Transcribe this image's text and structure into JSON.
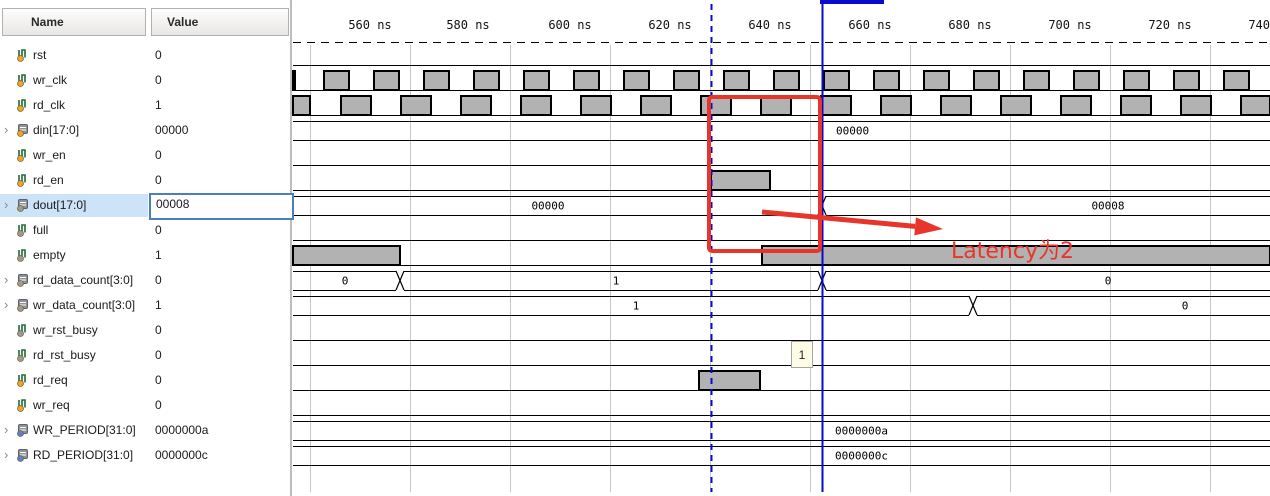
{
  "panel": {
    "columns": {
      "name": "Name",
      "value": "Value"
    },
    "signals": [
      {
        "name": "rst",
        "value": "0",
        "kind": "scalar",
        "dot": "input"
      },
      {
        "name": "wr_clk",
        "value": "0",
        "kind": "scalar",
        "dot": "input"
      },
      {
        "name": "rd_clk",
        "value": "1",
        "kind": "scalar",
        "dot": "input"
      },
      {
        "name": "din[17:0]",
        "value": "00000",
        "kind": "bus",
        "dot": "input"
      },
      {
        "name": "wr_en",
        "value": "0",
        "kind": "scalar",
        "dot": "input"
      },
      {
        "name": "rd_en",
        "value": "0",
        "kind": "scalar",
        "dot": "input"
      },
      {
        "name": "dout[17:0]",
        "value": "00008",
        "kind": "bus",
        "dot": "output",
        "selected": true
      },
      {
        "name": "full",
        "value": "0",
        "kind": "scalar",
        "dot": "output"
      },
      {
        "name": "empty",
        "value": "1",
        "kind": "scalar",
        "dot": "output"
      },
      {
        "name": "rd_data_count[3:0]",
        "value": "0",
        "kind": "bus",
        "dot": "output"
      },
      {
        "name": "wr_data_count[3:0]",
        "value": "1",
        "kind": "bus",
        "dot": "output"
      },
      {
        "name": "wr_rst_busy",
        "value": "0",
        "kind": "scalar",
        "dot": "output"
      },
      {
        "name": "rd_rst_busy",
        "value": "0",
        "kind": "scalar",
        "dot": "output"
      },
      {
        "name": "rd_req",
        "value": "0",
        "kind": "scalar",
        "dot": "input"
      },
      {
        "name": "wr_req",
        "value": "0",
        "kind": "scalar",
        "dot": "input"
      },
      {
        "name": "WR_PERIOD[31:0]",
        "value": "0000000a",
        "kind": "bus",
        "dot": "param"
      },
      {
        "name": "RD_PERIOD[31:0]",
        "value": "0000000c",
        "kind": "bus",
        "dot": "param"
      }
    ]
  },
  "colors": {
    "wave_line": "#000000",
    "pulse_fill": "#b2b2b2",
    "grid": "#c6c6c6",
    "cursor": "#0a0acd",
    "marker": "#0a0acd",
    "annotation": "#e8352b",
    "dot_input": "#f0a229",
    "dot_output": "#9a9a9a",
    "dot_param": "#5b7fd0",
    "icon_scalar": "#1e6b3c",
    "icon_bus": "#8f9399"
  },
  "waveform": {
    "x_start": 293,
    "x_end": 1270,
    "row_top": 46,
    "row_pitch": 25,
    "band_height": 19,
    "axis": {
      "y_label": 29,
      "y_line": 42,
      "ticks": [
        {
          "x": 370,
          "label": "560 ns"
        },
        {
          "x": 468,
          "label": "580 ns"
        },
        {
          "x": 570,
          "label": "600 ns"
        },
        {
          "x": 670,
          "label": "620 ns"
        },
        {
          "x": 770,
          "label": "640 ns"
        },
        {
          "x": 870,
          "label": "660 ns"
        },
        {
          "x": 970,
          "label": "680 ns"
        },
        {
          "x": 1070,
          "label": "700 ns"
        },
        {
          "x": 1170,
          "label": "720 ns"
        },
        {
          "x": 1270,
          "label": "740 ns"
        }
      ],
      "gridlines": [
        310,
        410,
        510,
        610,
        710,
        810,
        910,
        1010,
        1110,
        1210
      ]
    },
    "rows": [
      {
        "signal": "rst",
        "kind": "bit",
        "high": []
      },
      {
        "signal": "wr_clk",
        "kind": "bit",
        "high": [
          [
            293,
            295
          ],
          [
            324,
            349
          ],
          [
            374,
            399
          ],
          [
            424,
            449
          ],
          [
            474,
            499
          ],
          [
            524,
            549
          ],
          [
            574,
            599
          ],
          [
            624,
            649
          ],
          [
            674,
            699
          ],
          [
            724,
            749
          ],
          [
            774,
            799
          ],
          [
            824,
            849
          ],
          [
            874,
            899
          ],
          [
            924,
            949
          ],
          [
            974,
            999
          ],
          [
            1024,
            1049
          ],
          [
            1074,
            1099
          ],
          [
            1124,
            1149
          ],
          [
            1174,
            1199
          ],
          [
            1224,
            1249
          ]
        ]
      },
      {
        "signal": "rd_clk",
        "kind": "bit",
        "high": [
          [
            293,
            310
          ],
          [
            341,
            371
          ],
          [
            401,
            431
          ],
          [
            461,
            491
          ],
          [
            521,
            551
          ],
          [
            581,
            611
          ],
          [
            641,
            671
          ],
          [
            701,
            731
          ],
          [
            761,
            791
          ],
          [
            821,
            851
          ],
          [
            881,
            911
          ],
          [
            941,
            971
          ],
          [
            1001,
            1031
          ],
          [
            1061,
            1091
          ],
          [
            1121,
            1151
          ],
          [
            1181,
            1211
          ],
          [
            1241,
            1270
          ]
        ]
      },
      {
        "signal": "din",
        "kind": "bus",
        "trans": [],
        "labels": [
          {
            "x": 836,
            "text": "00000",
            "anchor": "start"
          }
        ]
      },
      {
        "signal": "wr_en",
        "kind": "bit",
        "high": []
      },
      {
        "signal": "rd_en",
        "kind": "bit",
        "high": [
          [
            711,
            770
          ]
        ]
      },
      {
        "signal": "dout",
        "kind": "bus",
        "trans": [
          822
        ],
        "labels": [
          {
            "x": 548,
            "text": "00000",
            "anchor": "middle"
          },
          {
            "x": 1108,
            "text": "00008",
            "anchor": "middle"
          }
        ]
      },
      {
        "signal": "full",
        "kind": "bit",
        "high": []
      },
      {
        "signal": "empty",
        "kind": "bit",
        "high": [
          [
            293,
            400
          ],
          [
            762,
            1270
          ]
        ]
      },
      {
        "signal": "rd_data_count",
        "kind": "bus",
        "trans": [
          400,
          822
        ],
        "labels": [
          {
            "x": 345,
            "text": "0",
            "anchor": "middle"
          },
          {
            "x": 616,
            "text": "1",
            "anchor": "middle"
          },
          {
            "x": 1108,
            "text": "0",
            "anchor": "middle"
          }
        ]
      },
      {
        "signal": "wr_data_count",
        "kind": "bus",
        "trans": [
          973
        ],
        "labels": [
          {
            "x": 636,
            "text": "1",
            "anchor": "middle"
          },
          {
            "x": 1185,
            "text": "0",
            "anchor": "middle"
          }
        ]
      },
      {
        "signal": "wr_rst_busy",
        "kind": "bit",
        "high": []
      },
      {
        "signal": "rd_rst_busy",
        "kind": "bit",
        "high": []
      },
      {
        "signal": "rd_req",
        "kind": "bit",
        "high": [
          [
            699,
            760
          ]
        ]
      },
      {
        "signal": "wr_req",
        "kind": "bit",
        "high": []
      },
      {
        "signal": "WR_PERIOD",
        "kind": "bus",
        "trans": [],
        "labels": [
          {
            "x": 835,
            "text": "0000000a",
            "anchor": "start"
          }
        ]
      },
      {
        "signal": "RD_PERIOD",
        "kind": "bus",
        "trans": [],
        "labels": [
          {
            "x": 835,
            "text": "0000000c",
            "anchor": "start"
          }
        ]
      }
    ],
    "cursor": {
      "x": 822,
      "top_bar": {
        "x1": 820,
        "x2": 884,
        "h": 4
      }
    },
    "marker": {
      "x": 711,
      "dashed": true
    }
  },
  "annotations": {
    "rect": {
      "x": 709,
      "y": 97,
      "w": 111,
      "h": 154
    },
    "arrow": {
      "x1": 762,
      "y1": 212,
      "x2": 943,
      "y2": 229
    },
    "label": {
      "text": "Latency为2",
      "x": 951,
      "y": 233
    },
    "tooltip": {
      "text": "1",
      "x": 791,
      "y": 341,
      "w": 22,
      "h": 27
    }
  }
}
